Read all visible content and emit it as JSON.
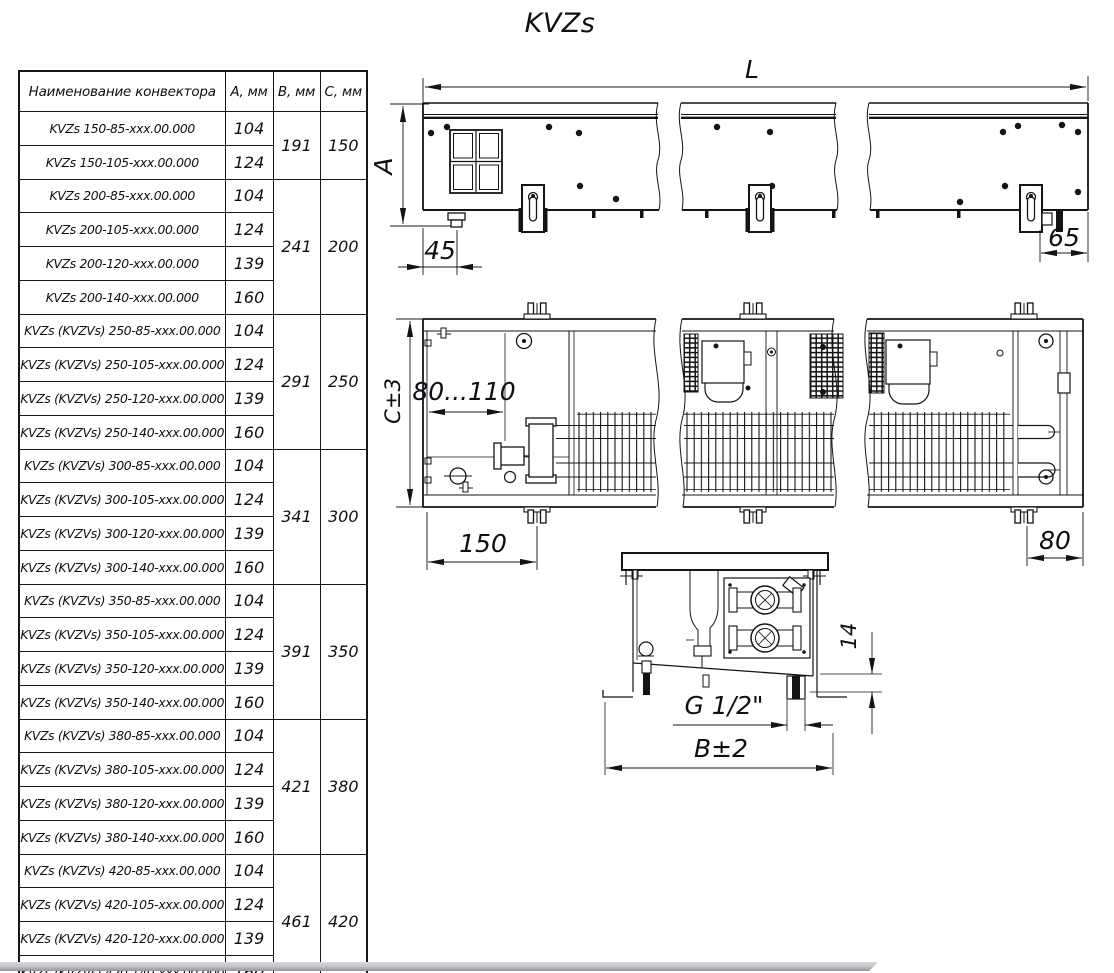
{
  "title": "KVZs",
  "table": {
    "headers": {
      "name": "Наименование конвектора",
      "a": "А, мм",
      "b": "В, мм",
      "c": "С, мм"
    },
    "rows": [
      {
        "name": "KVZs 150-85-xxx.00.000",
        "a": "104",
        "b": "191",
        "c": "150",
        "span": 2
      },
      {
        "name": "KVZs 150-105-xxx.00.000",
        "a": "124"
      },
      {
        "name": "KVZs 200-85-xxx.00.000",
        "a": "104",
        "b": "241",
        "c": "200",
        "span": 4
      },
      {
        "name": "KVZs 200-105-xxx.00.000",
        "a": "124"
      },
      {
        "name": "KVZs 200-120-xxx.00.000",
        "a": "139"
      },
      {
        "name": "KVZs 200-140-xxx.00.000",
        "a": "160"
      },
      {
        "name": "KVZs (KVZVs) 250-85-xxx.00.000",
        "a": "104",
        "b": "291",
        "c": "250",
        "span": 4
      },
      {
        "name": "KVZs (KVZVs) 250-105-xxx.00.000",
        "a": "124"
      },
      {
        "name": "KVZs (KVZVs) 250-120-xxx.00.000",
        "a": "139"
      },
      {
        "name": "KVZs (KVZVs) 250-140-xxx.00.000",
        "a": "160"
      },
      {
        "name": "KVZs (KVZVs) 300-85-xxx.00.000",
        "a": "104",
        "b": "341",
        "c": "300",
        "span": 4
      },
      {
        "name": "KVZs (KVZVs) 300-105-xxx.00.000",
        "a": "124"
      },
      {
        "name": "KVZs (KVZVs) 300-120-xxx.00.000",
        "a": "139"
      },
      {
        "name": "KVZs (KVZVs) 300-140-xxx.00.000",
        "a": "160"
      },
      {
        "name": "KVZs (KVZVs) 350-85-xxx.00.000",
        "a": "104",
        "b": "391",
        "c": "350",
        "span": 4
      },
      {
        "name": "KVZs (KVZVs) 350-105-xxx.00.000",
        "a": "124"
      },
      {
        "name": "KVZs (KVZVs) 350-120-xxx.00.000",
        "a": "139"
      },
      {
        "name": "KVZs (KVZVs) 350-140-xxx.00.000",
        "a": "160"
      },
      {
        "name": "KVZs (KVZVs) 380-85-xxx.00.000",
        "a": "104",
        "b": "421",
        "c": "380",
        "span": 4
      },
      {
        "name": "KVZs (KVZVs) 380-105-xxx.00.000",
        "a": "124"
      },
      {
        "name": "KVZs (KVZVs) 380-120-xxx.00.000",
        "a": "139"
      },
      {
        "name": "KVZs (KVZVs) 380-140-xxx.00.000",
        "a": "160"
      },
      {
        "name": "KVZs (KVZVs) 420-85-xxx.00.000",
        "a": "104",
        "b": "461",
        "c": "420",
        "span": 4
      },
      {
        "name": "KVZs (KVZVs) 420-105-xxx.00.000",
        "a": "124"
      },
      {
        "name": "KVZs (KVZVs) 420-120-xxx.00.000",
        "a": "139"
      },
      {
        "name": "KVZs (KVZVs) 420-140-xxx.00.000",
        "a": "160"
      }
    ]
  },
  "drawing": {
    "front_view": {
      "length": "L",
      "height": "A",
      "foot_offset": "45",
      "end_offset": "65"
    },
    "plan_view": {
      "depth": "C±3",
      "connection_zone": "80...110",
      "bracket_offset": "150",
      "bracket_end_offset": "80"
    },
    "section_view": {
      "protrusion": "14",
      "pipe_thread": "G 1/2\"",
      "width": "B±2"
    }
  },
  "colors": {
    "line": "#141418",
    "text": "#0e0e14",
    "page_edge": "#94949b",
    "background": "#ffffff"
  }
}
